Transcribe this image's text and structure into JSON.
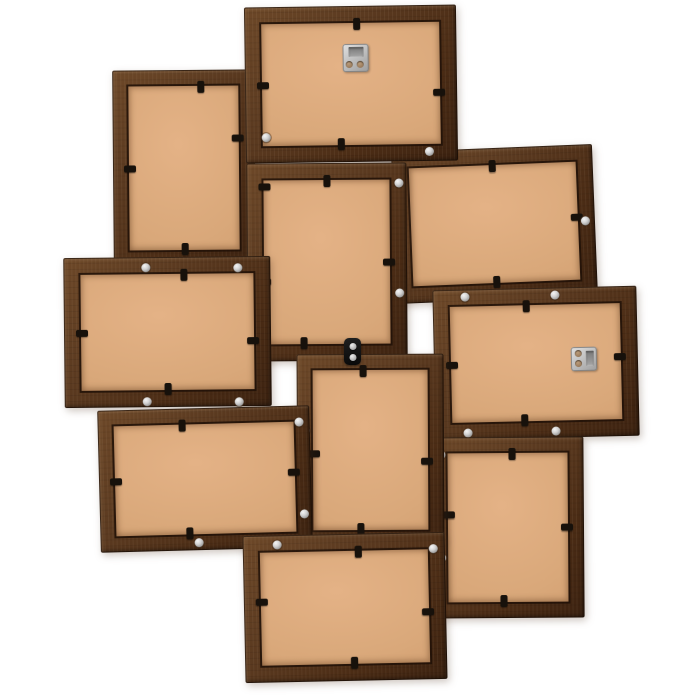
{
  "scene": {
    "description": "Back view of a wooden collage picture frame holding 10 photo frames, dark brown wood with tan MDF backing boards, on a white background",
    "width": 700,
    "height": 700,
    "background": "#ffffff"
  },
  "palette": {
    "frame_wood_light": "#6d4828",
    "frame_wood_mid": "#4b2c15",
    "frame_wood_dark": "#2a1709",
    "backing_tan_light": "#e4b286",
    "backing_tan": "#d9a87a",
    "backing_tan_dark": "#cd9a6c",
    "clip_black": "#17110b",
    "screw_silver": "#d2d2d2",
    "hanger_silver": "#c0c0c0",
    "bracket_black": "#111111"
  },
  "frames": [
    {
      "id": "top-center",
      "x": 245,
      "y": 6,
      "w": 212,
      "h": 156,
      "border": 17,
      "rot": -0.8,
      "z": 2,
      "clips": [
        {
          "side": "top",
          "t": 0.53
        },
        {
          "side": "left",
          "t": 0.5
        },
        {
          "side": "right",
          "t": 0.56
        },
        {
          "side": "bottom",
          "t": 0.45
        }
      ],
      "screws": [
        [
          20,
          130
        ],
        [
          183,
          146
        ]
      ],
      "hanger": {
        "x": 98,
        "y": 38,
        "w": 26,
        "h": 28,
        "variant": "slot-top"
      }
    },
    {
      "id": "top-left",
      "x": 113,
      "y": 70,
      "w": 142,
      "h": 196,
      "border": 16,
      "rot": -0.5,
      "z": 1,
      "clips": [
        {
          "side": "top",
          "t": 0.62
        },
        {
          "side": "left",
          "t": 0.5
        },
        {
          "side": "right",
          "t": 0.35
        },
        {
          "side": "bottom",
          "t": 0.5
        }
      ],
      "screws": []
    },
    {
      "id": "center-portrait",
      "x": 247,
      "y": 163,
      "w": 160,
      "h": 198,
      "border": 17,
      "rot": -0.4,
      "z": 3,
      "clips": [
        {
          "side": "top",
          "t": 0.5
        },
        {
          "side": "left",
          "t": 0.12
        },
        {
          "side": "left",
          "t": 0.6
        },
        {
          "side": "right",
          "t": 0.5
        },
        {
          "side": "bottom",
          "t": 0.35
        }
      ],
      "screws": [
        [
          152,
          20
        ],
        [
          152,
          130
        ]
      ]
    },
    {
      "id": "top-right",
      "x": 394,
      "y": 148,
      "w": 201,
      "h": 152,
      "border": 17,
      "rot": -2.3,
      "z": 1,
      "clips": [
        {
          "side": "top",
          "t": 0.5
        },
        {
          "side": "right",
          "t": 0.48
        },
        {
          "side": "bottom",
          "t": 0.5
        }
      ],
      "screws": [
        [
          191,
          76
        ]
      ]
    },
    {
      "id": "middle-left",
      "x": 64,
      "y": 257,
      "w": 207,
      "h": 150,
      "border": 17,
      "rot": -0.6,
      "z": 4,
      "clips": [
        {
          "side": "top",
          "t": 0.58
        },
        {
          "side": "left",
          "t": 0.5
        },
        {
          "side": "right",
          "t": 0.56
        },
        {
          "side": "bottom",
          "t": 0.5
        }
      ],
      "screws": [
        [
          82,
          10
        ],
        [
          174,
          11
        ],
        [
          82,
          144
        ],
        [
          174,
          145
        ]
      ]
    },
    {
      "id": "middle-right",
      "x": 434,
      "y": 288,
      "w": 204,
      "h": 150,
      "border": 17,
      "rot": -1.3,
      "z": 4,
      "clips": [
        {
          "side": "top",
          "t": 0.46
        },
        {
          "side": "left",
          "t": 0.5
        },
        {
          "side": "right",
          "t": 0.47
        },
        {
          "side": "bottom",
          "t": 0.44
        }
      ],
      "screws": [
        [
          32,
          7
        ],
        [
          122,
          7
        ],
        [
          32,
          143
        ],
        [
          120,
          143
        ]
      ],
      "hanger": {
        "x": 137,
        "y": 60,
        "w": 26,
        "h": 24,
        "variant": "slot-right"
      }
    },
    {
      "id": "bottom-center-portrait",
      "x": 297,
      "y": 354,
      "w": 147,
      "h": 192,
      "border": 16,
      "rot": -0.3,
      "z": 6,
      "clips": [
        {
          "side": "top",
          "t": 0.45
        },
        {
          "side": "left",
          "t": 0.52
        },
        {
          "side": "right",
          "t": 0.56
        },
        {
          "side": "bottom",
          "t": 0.43
        }
      ],
      "screws": [
        [
          8,
          76
        ],
        [
          8,
          163
        ]
      ]
    },
    {
      "id": "bottom-right",
      "x": 432,
      "y": 437,
      "w": 152,
      "h": 181,
      "border": 16,
      "rot": -0.4,
      "z": 5,
      "clips": [
        {
          "side": "top",
          "t": 0.53
        },
        {
          "side": "left",
          "t": 0.43
        },
        {
          "side": "right",
          "t": 0.5
        },
        {
          "side": "bottom",
          "t": 0.47
        }
      ],
      "screws": [
        [
          9,
          17
        ],
        [
          9,
          120
        ]
      ]
    },
    {
      "id": "bottom-center",
      "x": 244,
      "y": 534,
      "w": 202,
      "h": 147,
      "border": 17,
      "rot": -1.2,
      "z": 7,
      "clips": [
        {
          "side": "top",
          "t": 0.57
        },
        {
          "side": "left",
          "t": 0.45
        },
        {
          "side": "right",
          "t": 0.54
        },
        {
          "side": "bottom",
          "t": 0.54
        }
      ],
      "screws": [
        [
          34,
          9
        ],
        [
          190,
          16
        ]
      ]
    },
    {
      "id": "bottom-left",
      "x": 99,
      "y": 408,
      "w": 212,
      "h": 142,
      "border": 16,
      "rot": -1.5,
      "z": 6,
      "clips": [
        {
          "side": "top",
          "t": 0.4
        },
        {
          "side": "left",
          "t": 0.5
        },
        {
          "side": "right",
          "t": 0.47
        },
        {
          "side": "bottom",
          "t": 0.42
        }
      ],
      "screws": [
        [
          201,
          16
        ],
        [
          204,
          108
        ],
        [
          98,
          134
        ]
      ]
    }
  ],
  "wall_bracket": {
    "x": 344,
    "y": 338,
    "w": 17,
    "h": 27,
    "screw_ys": [
      5,
      16
    ]
  }
}
